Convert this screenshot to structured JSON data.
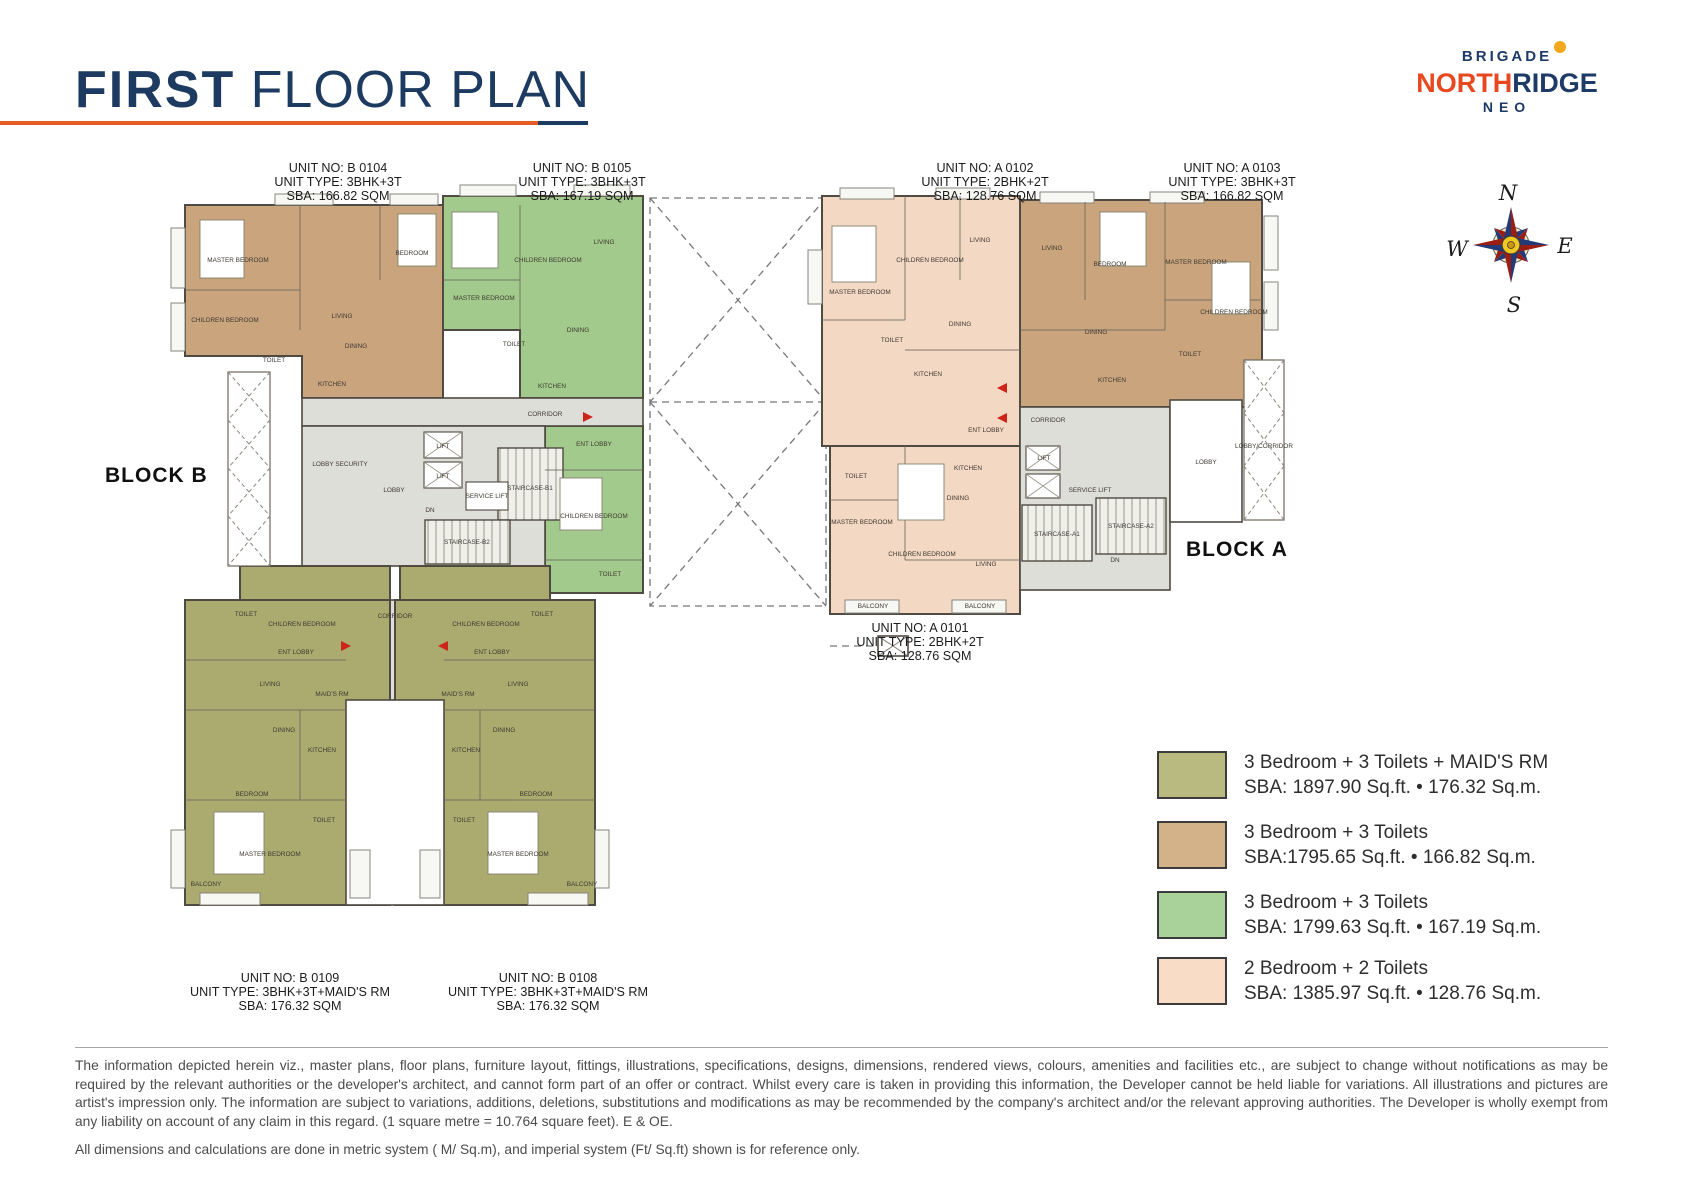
{
  "header": {
    "title_bold": "FIRST",
    "title_rest": " FLOOR PLAN"
  },
  "logo": {
    "brigade": "BRIGADE",
    "north": "NORTH",
    "ridge": "RIDGE",
    "neo": "NEO"
  },
  "compass": {
    "n": "N",
    "e": "E",
    "s": "S",
    "w": "W"
  },
  "blocks": {
    "b": "BLOCK B",
    "a": "BLOCK A"
  },
  "units": [
    {
      "no": "UNIT NO: B 0104",
      "type": "UNIT TYPE: 3BHK+3T",
      "sba": "SBA: 166.82 SQM"
    },
    {
      "no": "UNIT NO: B 0105",
      "type": "UNIT TYPE: 3BHK+3T",
      "sba": "SBA: 167.19 SQM"
    },
    {
      "no": "UNIT NO: A 0102",
      "type": "UNIT TYPE: 2BHK+2T",
      "sba": "SBA: 128.76 SQM"
    },
    {
      "no": "UNIT NO: A 0103",
      "type": "UNIT TYPE: 3BHK+3T",
      "sba": "SBA: 166.82 SQM"
    },
    {
      "no": "UNIT NO: A 0101",
      "type": "UNIT TYPE: 2BHK+2T",
      "sba": "SBA: 128.76 SQM"
    },
    {
      "no": "UNIT NO: B 0109",
      "type": "UNIT TYPE: 3BHK+3T+MAID'S RM",
      "sba": "SBA: 176.32 SQM"
    },
    {
      "no": "UNIT NO: B 0108",
      "type": "UNIT TYPE: 3BHK+3T+MAID'S RM",
      "sba": "SBA: 176.32 SQM"
    }
  ],
  "legend": {
    "items": [
      {
        "label": "3 Bedroom + 3 Toilets + MAID'S RM",
        "sba": "SBA: 1897.90 Sq.ft. • 176.32 Sq.m.",
        "color": "#b9ba80"
      },
      {
        "label": "3 Bedroom + 3 Toilets",
        "sba": "SBA:1795.65 Sq.ft. • 166.82 Sq.m.",
        "color": "#d3b189"
      },
      {
        "label": "3 Bedroom + 3 Toilets",
        "sba": "SBA: 1799.63 Sq.ft. • 167.19 Sq.m.",
        "color": "#a9d29a"
      },
      {
        "label": "2 Bedroom + 2 Toilets",
        "sba": "SBA: 1385.97 Sq.ft. • 128.76 Sq.m.",
        "color": "#f8dcc6"
      }
    ]
  },
  "plan": {
    "colors": {
      "tan": "#c9a47d",
      "green": "#a2ca8c",
      "olive": "#abab70",
      "pink": "#f3d8c4",
      "corridor": "#deded8",
      "wall": "#4f4a42",
      "entry_arrow": "#cc2418"
    },
    "rooms": [
      {
        "x": 238,
        "y": 262,
        "t": "MASTER BEDROOM"
      },
      {
        "x": 225,
        "y": 322,
        "t": "CHILDREN BEDROOM"
      },
      {
        "x": 412,
        "y": 255,
        "t": "BEDROOM"
      },
      {
        "x": 342,
        "y": 318,
        "t": "LIVING"
      },
      {
        "x": 356,
        "y": 348,
        "t": "DINING"
      },
      {
        "x": 332,
        "y": 386,
        "t": "KITCHEN"
      },
      {
        "x": 274,
        "y": 362,
        "t": "TOILET"
      },
      {
        "x": 484,
        "y": 300,
        "t": "MASTER BEDROOM"
      },
      {
        "x": 548,
        "y": 262,
        "t": "CHILDREN BEDROOM"
      },
      {
        "x": 604,
        "y": 244,
        "t": "LIVING"
      },
      {
        "x": 578,
        "y": 332,
        "t": "DINING"
      },
      {
        "x": 552,
        "y": 388,
        "t": "KITCHEN"
      },
      {
        "x": 514,
        "y": 346,
        "t": "TOILET"
      },
      {
        "x": 594,
        "y": 446,
        "t": "ENT LOBBY"
      },
      {
        "x": 594,
        "y": 518,
        "t": "CHILDREN BEDROOM"
      },
      {
        "x": 610,
        "y": 576,
        "t": "TOILET"
      },
      {
        "x": 340,
        "y": 466,
        "t": "LOBBY SECURITY"
      },
      {
        "x": 394,
        "y": 492,
        "t": "LOBBY"
      },
      {
        "x": 545,
        "y": 416,
        "t": "CORRIDOR"
      },
      {
        "x": 443,
        "y": 448,
        "t": "LIFT"
      },
      {
        "x": 443,
        "y": 478,
        "t": "LIFT"
      },
      {
        "x": 487,
        "y": 498,
        "t": "SERVICE LIFT"
      },
      {
        "x": 530,
        "y": 490,
        "t": "STAIRCASE-B1"
      },
      {
        "x": 467,
        "y": 544,
        "t": "STAIRCASE-B2"
      },
      {
        "x": 430,
        "y": 512,
        "t": "DN"
      },
      {
        "x": 395,
        "y": 618,
        "t": "CORRIDOR"
      },
      {
        "x": 302,
        "y": 626,
        "t": "CHILDREN BEDROOM"
      },
      {
        "x": 296,
        "y": 654,
        "t": "ENT LOBBY"
      },
      {
        "x": 246,
        "y": 616,
        "t": "TOILET"
      },
      {
        "x": 270,
        "y": 686,
        "t": "LIVING"
      },
      {
        "x": 332,
        "y": 696,
        "t": "MAID'S RM"
      },
      {
        "x": 284,
        "y": 732,
        "t": "DINING"
      },
      {
        "x": 322,
        "y": 752,
        "t": "KITCHEN"
      },
      {
        "x": 252,
        "y": 796,
        "t": "BEDROOM"
      },
      {
        "x": 324,
        "y": 822,
        "t": "TOILET"
      },
      {
        "x": 270,
        "y": 856,
        "t": "MASTER BEDROOM"
      },
      {
        "x": 206,
        "y": 886,
        "t": "BALCONY"
      },
      {
        "x": 486,
        "y": 626,
        "t": "CHILDREN BEDROOM"
      },
      {
        "x": 492,
        "y": 654,
        "t": "ENT LOBBY"
      },
      {
        "x": 542,
        "y": 616,
        "t": "TOILET"
      },
      {
        "x": 518,
        "y": 686,
        "t": "LIVING"
      },
      {
        "x": 458,
        "y": 696,
        "t": "MAID'S RM"
      },
      {
        "x": 504,
        "y": 732,
        "t": "DINING"
      },
      {
        "x": 466,
        "y": 752,
        "t": "KITCHEN"
      },
      {
        "x": 536,
        "y": 796,
        "t": "BEDROOM"
      },
      {
        "x": 464,
        "y": 822,
        "t": "TOILET"
      },
      {
        "x": 518,
        "y": 856,
        "t": "MASTER BEDROOM"
      },
      {
        "x": 582,
        "y": 886,
        "t": "BALCONY"
      },
      {
        "x": 860,
        "y": 294,
        "t": "MASTER BEDROOM"
      },
      {
        "x": 930,
        "y": 262,
        "t": "CHILDREN BEDROOM"
      },
      {
        "x": 980,
        "y": 242,
        "t": "LIVING"
      },
      {
        "x": 960,
        "y": 326,
        "t": "DINING"
      },
      {
        "x": 928,
        "y": 376,
        "t": "KITCHEN"
      },
      {
        "x": 892,
        "y": 342,
        "t": "TOILET"
      },
      {
        "x": 986,
        "y": 432,
        "t": "ENT LOBBY"
      },
      {
        "x": 856,
        "y": 478,
        "t": "TOILET"
      },
      {
        "x": 862,
        "y": 524,
        "t": "MASTER BEDROOM"
      },
      {
        "x": 922,
        "y": 556,
        "t": "CHILDREN BEDROOM"
      },
      {
        "x": 986,
        "y": 566,
        "t": "LIVING"
      },
      {
        "x": 958,
        "y": 500,
        "t": "DINING"
      },
      {
        "x": 968,
        "y": 470,
        "t": "KITCHEN"
      },
      {
        "x": 873,
        "y": 608,
        "t": "BALCONY"
      },
      {
        "x": 980,
        "y": 608,
        "t": "BALCONY"
      },
      {
        "x": 1052,
        "y": 250,
        "t": "LIVING"
      },
      {
        "x": 1110,
        "y": 266,
        "t": "BEDROOM"
      },
      {
        "x": 1196,
        "y": 264,
        "t": "MASTER BEDROOM"
      },
      {
        "x": 1234,
        "y": 314,
        "t": "CHILDREN BEDROOM"
      },
      {
        "x": 1096,
        "y": 334,
        "t": "DINING"
      },
      {
        "x": 1112,
        "y": 382,
        "t": "KITCHEN"
      },
      {
        "x": 1190,
        "y": 356,
        "t": "TOILET"
      },
      {
        "x": 1048,
        "y": 422,
        "t": "CORRIDOR"
      },
      {
        "x": 1044,
        "y": 460,
        "t": "LIFT"
      },
      {
        "x": 1090,
        "y": 492,
        "t": "SERVICE LIFT"
      },
      {
        "x": 1057,
        "y": 536,
        "t": "STAIRCASE-A1"
      },
      {
        "x": 1131,
        "y": 528,
        "t": "STAIRCASE-A2"
      },
      {
        "x": 1115,
        "y": 562,
        "t": "DN"
      },
      {
        "x": 1206,
        "y": 464,
        "t": "LOBBY"
      },
      {
        "x": 1264,
        "y": 448,
        "t": "LOBBY/CORRIDOR"
      }
    ]
  },
  "disclaimer": {
    "para1": "The information depicted herein viz., master plans, floor plans, furniture layout, fittings, illustrations, specifications, designs, dimensions, rendered views, colours, amenities and facilities etc., are subject to change without notifications as may be required by the relevant authorities or the developer's architect, and cannot form part of an offer or contract. Whilst every care is taken in providing this information, the Developer cannot be held liable for variations. All illustrations and pictures are artist's impression only. The information are subject to variations, additions, deletions, substitutions and modifications as may be recommended by the company's architect and/or the relevant approving authorities. The Developer is wholly exempt from any liability on account of any claim in this regard. (1 square metre = 10.764 square feet). E & OE.",
    "para2": "All dimensions and calculations are done in metric system ( M/ Sq.m), and imperial system (Ft/ Sq.ft) shown is for reference only."
  }
}
